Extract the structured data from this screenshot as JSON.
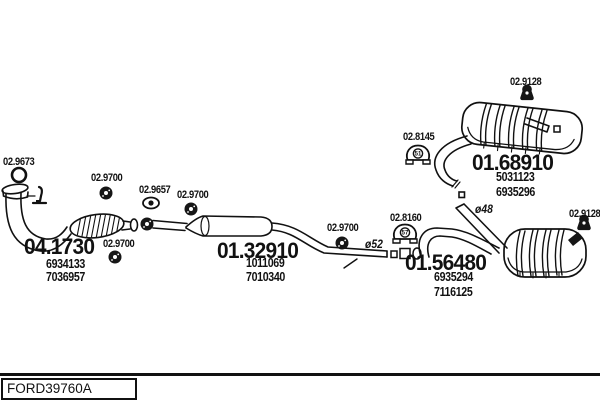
{
  "diagram_type": "exhaust-system-parts-diagram",
  "footer": {
    "drawing_code": "FORD39760A"
  },
  "assemblies": {
    "catalyst": {
      "code": "04.1730",
      "oe": [
        "6934133",
        "7036957"
      ]
    },
    "centre_silencer": {
      "code": "01.32910",
      "oe": [
        "1011069",
        "7010340"
      ]
    },
    "rear_silencer_top": {
      "code": "01.68910",
      "oe": [
        "5031123",
        "6935296"
      ]
    },
    "rear_silencer_bottom": {
      "code": "01.56480",
      "oe": [
        "6935294",
        "7116125"
      ]
    }
  },
  "callouts": {
    "gasket": "02.9673",
    "clamp1": "02.9700",
    "clamp2": "02.9657",
    "clamp3": "02.9700",
    "clamp4": "02.9700",
    "clamp5": "02.9700",
    "hanger1": "02.8145",
    "hanger2": "02.8160",
    "hanger3": "02.9128",
    "hanger4": "02.9128"
  },
  "icon_numbers": {
    "hanger1": "51",
    "hanger2": "57"
  },
  "annotations": {
    "dia52": "ø52",
    "dia48": "ø48"
  },
  "colors": {
    "ink": "#111111",
    "background": "#ffffff"
  }
}
